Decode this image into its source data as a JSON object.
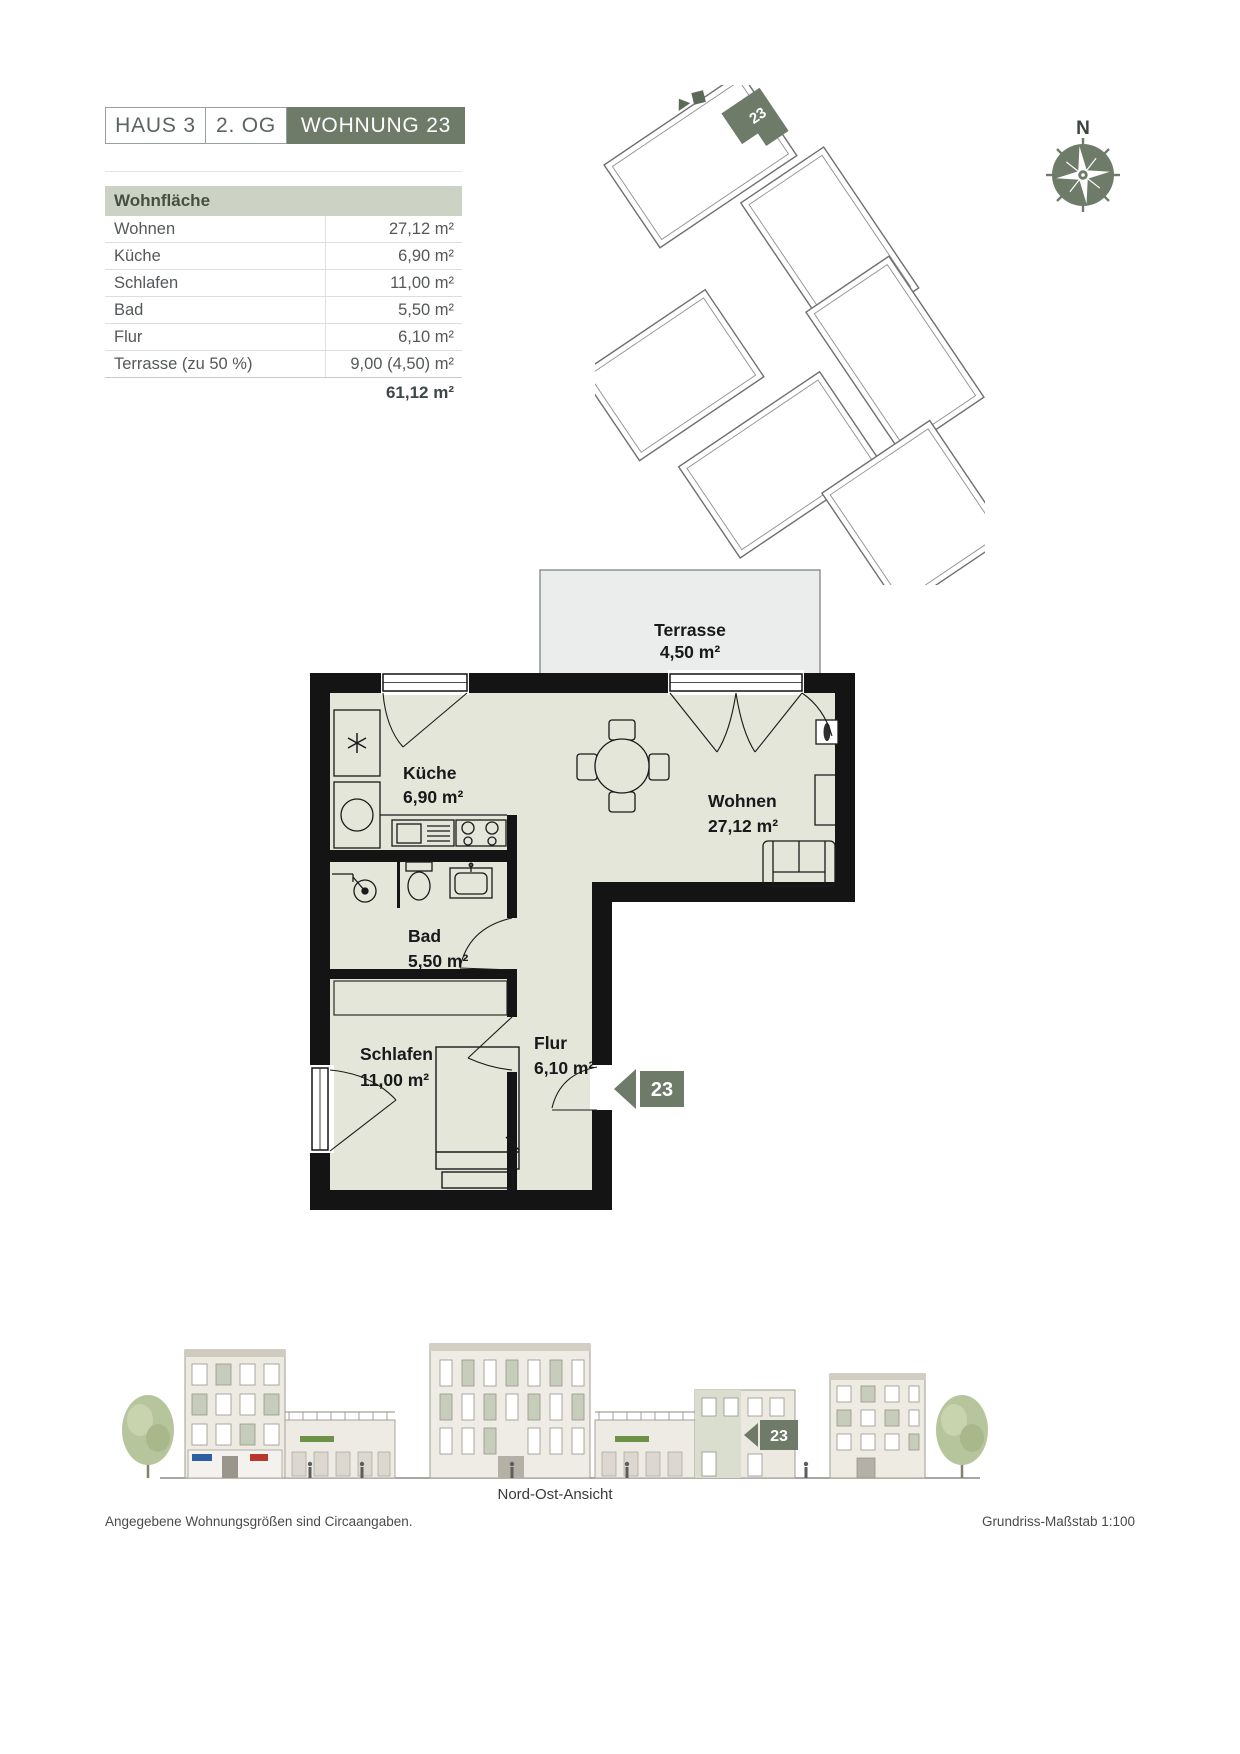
{
  "header": {
    "haus_label": "HAUS 3",
    "floor_label": "2. OG",
    "unit_label": "WOHNUNG 23"
  },
  "area_table": {
    "title": "Wohnfläche",
    "rows": [
      {
        "label": "Wohnen",
        "value": "27,12 m²"
      },
      {
        "label": "Küche",
        "value": "6,90 m²"
      },
      {
        "label": "Schlafen",
        "value": "11,00 m²"
      },
      {
        "label": "Bad",
        "value": "5,50 m²"
      },
      {
        "label": "Flur",
        "value": "6,10 m²"
      },
      {
        "label": "Terrasse (zu 50 %)",
        "value": "9,00 (4,50) m²"
      }
    ],
    "total_value": "61,12 m²"
  },
  "site_plan": {
    "unit_marker": "23"
  },
  "compass": {
    "north_label": "N"
  },
  "floor_plan": {
    "rooms": [
      {
        "name": "Terrasse",
        "area": "4,50 m²"
      },
      {
        "name": "Küche",
        "area": "6,90 m²"
      },
      {
        "name": "Wohnen",
        "area": "27,12 m²"
      },
      {
        "name": "Bad",
        "area": "5,50 m²"
      },
      {
        "name": "Schlafen",
        "area": "11,00 m²"
      },
      {
        "name": "Flur",
        "area": "6,10 m²"
      }
    ],
    "entrance_marker": "23"
  },
  "elevation": {
    "caption": "Nord-Ost-Ansicht",
    "unit_marker": "23"
  },
  "footer": {
    "left_note": "Angegebene Wohnungsgrößen sind Circaangaben.",
    "right_note": "Grundriss-Maßstab 1:100"
  },
  "colors": {
    "accent": "#6e7b69",
    "table_header_bg": "#cdd3c4",
    "room_fill": "#e3e6d8",
    "terrace_fill": "#ebedec"
  }
}
